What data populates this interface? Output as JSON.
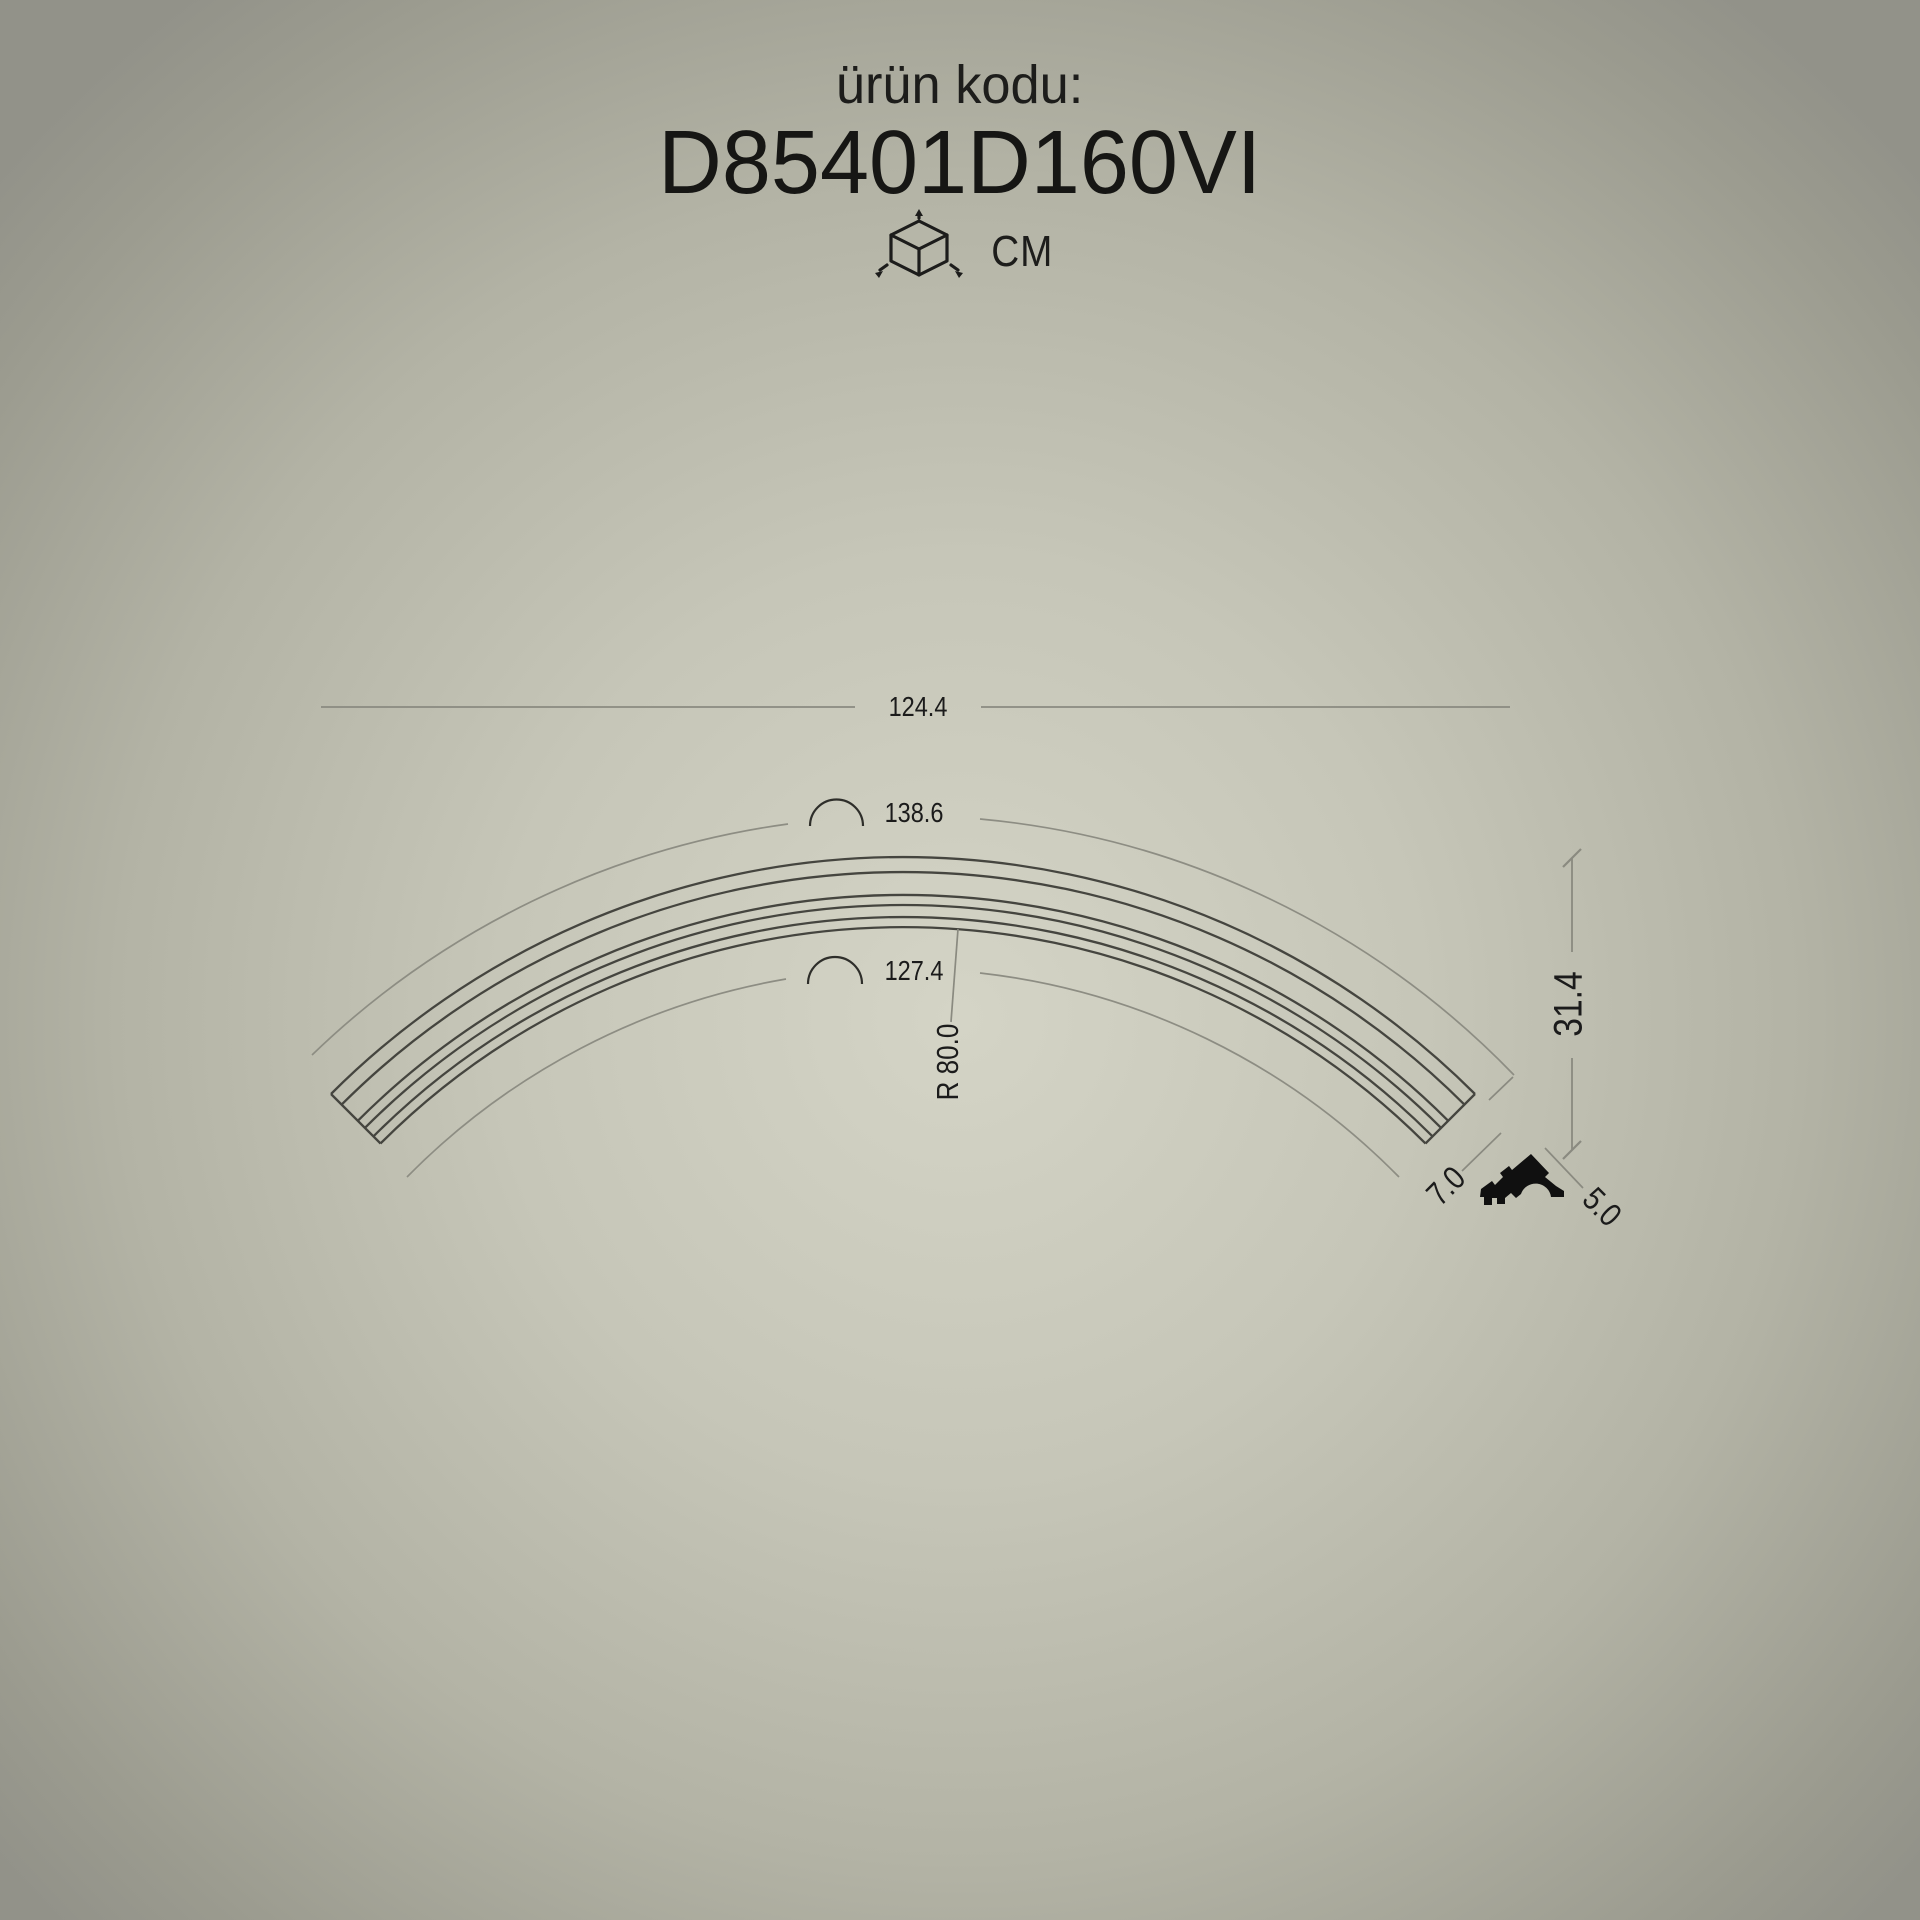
{
  "header": {
    "label": "ürün kodu:",
    "code": "D85401D160VI",
    "unit": "CM",
    "unit_icon": "cube-3d-dimensions-icon"
  },
  "drawing": {
    "type": "curved crown moulding technical drawing, quarter-circle arc band with section profile",
    "dimensions": {
      "chord_width": "124.4",
      "outer_arc_length": "138.6",
      "inner_arc_length": "127.4",
      "radius": "R 80.0",
      "height": "31.4",
      "end_width": "7.0",
      "profile_height": "5.0"
    }
  },
  "colors": {
    "background_center": "#d4d4c6",
    "background_edge": "#929289",
    "moulding_line": "#45453f",
    "dimension_line": "#8a8a80",
    "text": "#1b1b1b",
    "profile_fill": "#101010"
  }
}
